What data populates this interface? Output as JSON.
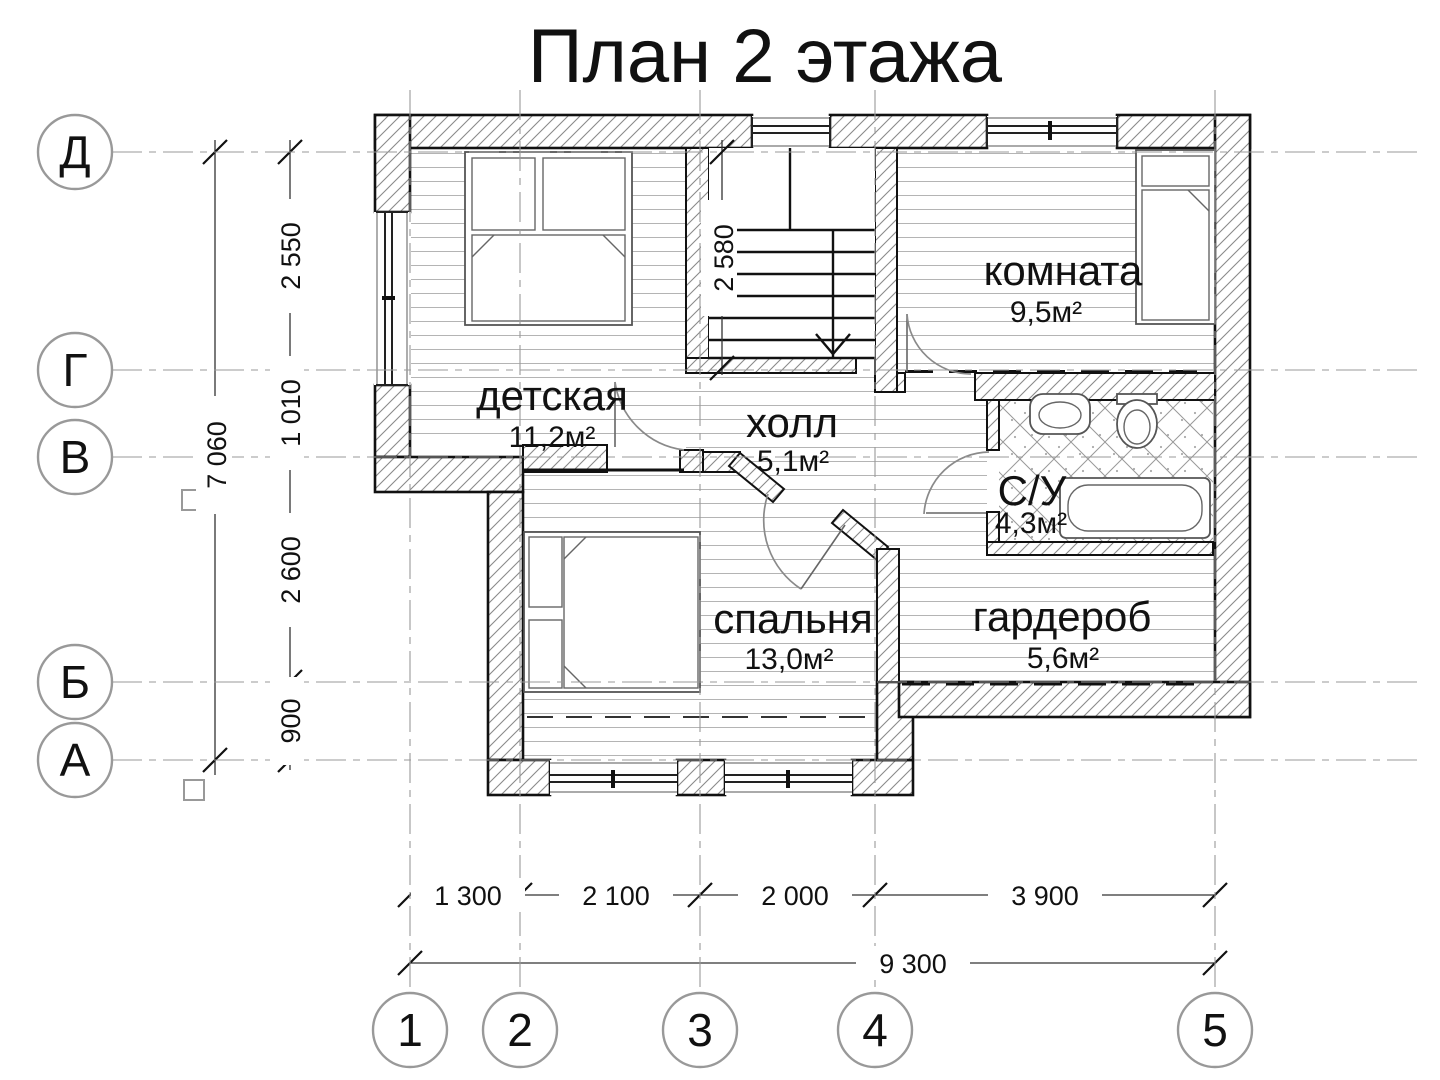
{
  "title": "План 2 этажа",
  "axis": {
    "rows": [
      "Д",
      "Г",
      "В",
      "Б",
      "А"
    ],
    "cols": [
      "1",
      "2",
      "3",
      "4",
      "5"
    ]
  },
  "dimensions": {
    "left_total": "7 060",
    "left_segments": [
      "2 550",
      "1 010",
      "2 600",
      "900"
    ],
    "bottom_segments": [
      "1 300",
      "2 100",
      "2 000",
      "3 900"
    ],
    "bottom_total": "9 300",
    "stairs": "2 580"
  },
  "rooms": {
    "detskaya": {
      "name": "детская",
      "area": "11,2м²"
    },
    "hall": {
      "name": "холл",
      "area": "5,1м²"
    },
    "komnata": {
      "name": "комната",
      "area": "9,5м²"
    },
    "su": {
      "name": "С/У",
      "area": "4,3м²"
    },
    "spalnya": {
      "name": "спальня",
      "area": "13,0м²"
    },
    "garderob": {
      "name": "гардероб",
      "area": "5,6м²"
    }
  }
}
